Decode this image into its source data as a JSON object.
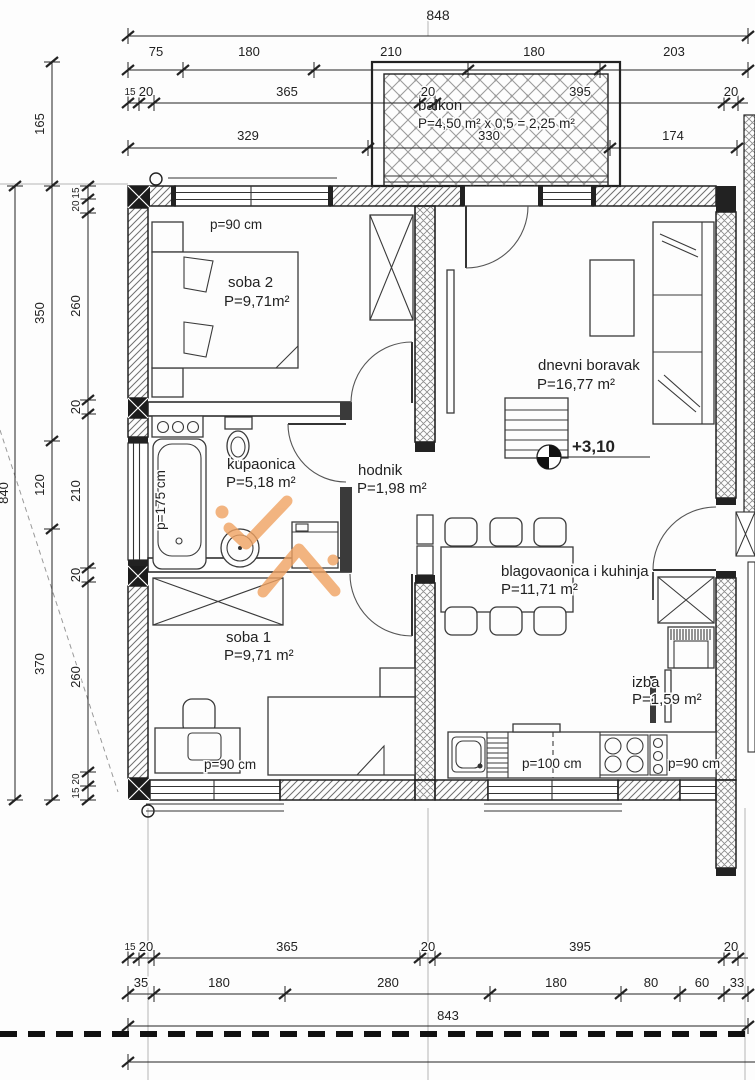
{
  "title": "apartment floor plan",
  "colors": {
    "ink": "#222222",
    "hatch": "#6f6f6f",
    "lattice": "#8a8a8a",
    "watermark": "#f0a262",
    "background": "#fdfdfd"
  },
  "rooms": {
    "balkon": {
      "name": "balkon",
      "area": "P=4,50 m² x 0,5 = 2,25 m²"
    },
    "soba2": {
      "name": "soba 2",
      "area": "P=9,71m²",
      "wall_note": "p=90 cm"
    },
    "kupaonica": {
      "name": "kupaonica",
      "area": "P=5,18 m²",
      "tub_note": "p=175 cm"
    },
    "hodnik": {
      "name": "hodnik",
      "area": "P=1,98 m²"
    },
    "dnevni_boravak": {
      "name": "dnevni boravak",
      "area": "P=16,77 m²",
      "elevation": "+3,10"
    },
    "blagovaonica": {
      "name": "blagovaonica i kuhinja",
      "area": "P=11,71 m²",
      "counter_note": "p=100 cm",
      "counter_note_right": "p=90 cm"
    },
    "izba": {
      "name": "izba",
      "area": "P=1,59 m²"
    },
    "soba1": {
      "name": "soba 1",
      "area": "P=9,71 m²",
      "wall_note": "p=90 cm"
    }
  },
  "dims": {
    "top": {
      "total": "848",
      "row2": [
        "75",
        "180",
        "210",
        "180",
        "203"
      ],
      "row3": [
        "15",
        "20",
        "365",
        "20",
        "395",
        "20"
      ],
      "row4": [
        "329",
        "330",
        "174"
      ]
    },
    "left": {
      "total": "840",
      "h165": "165",
      "mid": [
        "350",
        "120",
        "370"
      ],
      "inner": [
        "15",
        "20",
        "260",
        "20",
        "210",
        "20",
        "260",
        "20",
        "15"
      ]
    },
    "bottom": {
      "row1": [
        "15",
        "20",
        "365",
        "20",
        "395",
        "20"
      ],
      "row2": [
        "35",
        "180",
        "280",
        "180",
        "80",
        "60",
        "33"
      ],
      "total": "843"
    }
  }
}
